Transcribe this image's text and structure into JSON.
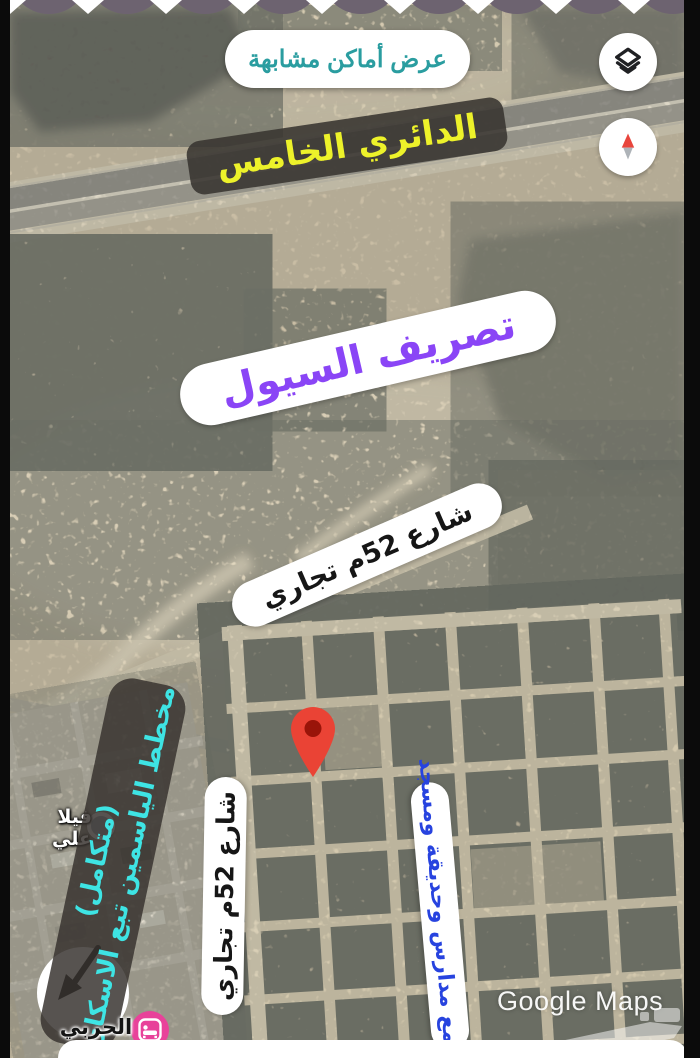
{
  "app": {
    "similar_places_button": "عرض أماكن مشابهة",
    "google_watermark": "Google Maps"
  },
  "annotations": {
    "ring_road": "الدائري الخامس",
    "flood_channel": "تصريف السيول",
    "street_52_diagonal": "شارع 52م تجاري",
    "street_52_vertical": "شارع 52م تجاري",
    "yasmin_plan_sub": "(متكامل)",
    "yasmin_plan_main": "مخطط الياسمين تبع الاسكان",
    "schools_complex": "مجمع مدارس وحديقة ومسجد"
  },
  "poi": {
    "villa_ali": "فيلا علي",
    "harbi": "الحربي"
  },
  "icons": {
    "layers": "layers-icon",
    "compass": "compass-icon",
    "marker": "map-pin-icon",
    "lodging": "bed-icon",
    "poi_dot": "poi-dot-icon",
    "bottom_watermark": "haraj-logo"
  },
  "colors": {
    "accent_teal": "#2a9da0",
    "ring_road_text": "#edf22a",
    "flood_text": "#8a45f6",
    "street_text": "#161616",
    "yasmin_text": "#3ee4e4",
    "schools_text": "#2743df",
    "sticker_dark_bg": "#38342f",
    "pin_red": "#ea4335",
    "lodging_pink": "#e8429a"
  }
}
